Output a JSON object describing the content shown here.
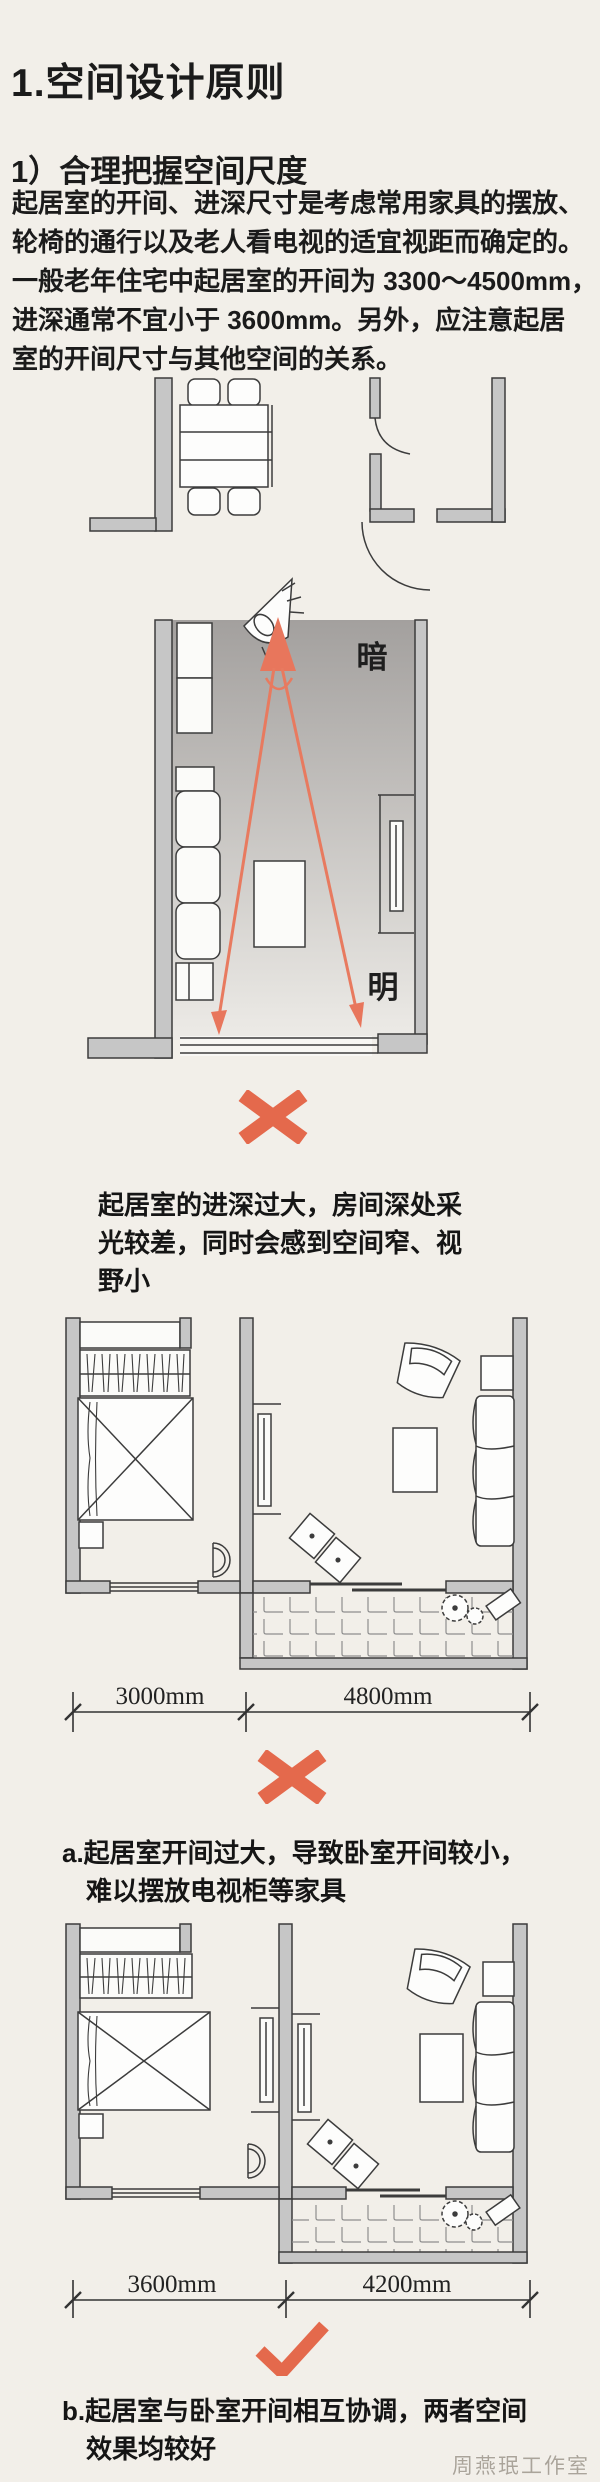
{
  "page": {
    "bg_color": "#f2efe9",
    "accent_color": "#e4694c",
    "arrow_color": "#e87a5f",
    "wall_color": "#c6c6c6"
  },
  "article": {
    "title": "1.空间设计原则",
    "subtitle": "1）合理把握空间尺度",
    "paragraph_lines": [
      "起居室的开间、进深尺寸是考虑常用家具的摆放、",
      "轮椅的通行以及老人看电视的适宜视距而确定的。",
      "一般老年住宅中起居室的开间为 3300～4500mm，",
      "进深通常不宜小于 3600mm。另外，应注意起居",
      "室的开间尺寸与其他空间的关系。"
    ]
  },
  "figures": {
    "sightline_plan": {
      "label_dark": "暗",
      "label_bright": "明",
      "verdict": "cross",
      "caption_lines": [
        "起居室的进深过大，房间深处采",
        "光较差，同时会感到空间窄、视",
        "野小"
      ]
    },
    "bad_layout_plan": {
      "dim_left": "3000mm",
      "dim_right": "4800mm",
      "verdict": "cross",
      "caption_lines": [
        "a.起居室开间过大，导致卧室开间较小，",
        "难以摆放电视柜等家具"
      ]
    },
    "good_layout_plan": {
      "dim_left": "3600mm",
      "dim_right": "4200mm",
      "verdict": "check",
      "caption_lines": [
        "b.起居室与卧室开间相互协调，两者空间",
        "效果均较好"
      ]
    }
  },
  "watermark": "周燕珉工作室"
}
